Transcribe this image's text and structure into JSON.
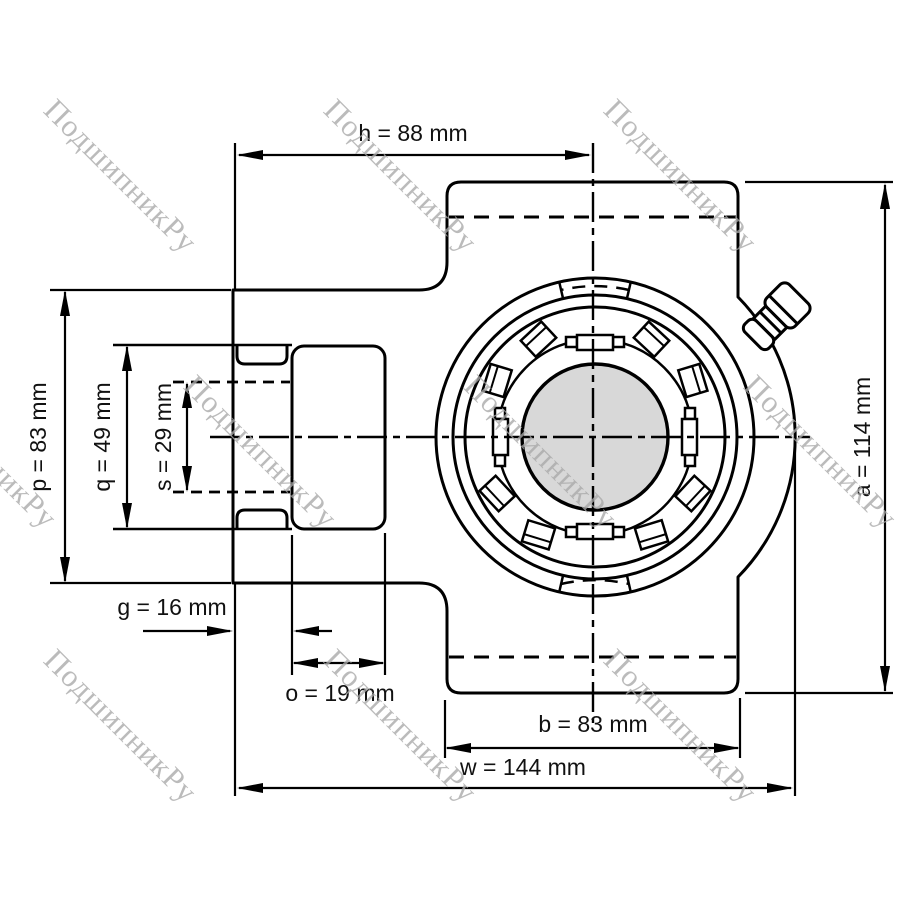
{
  "drawing": {
    "dims": {
      "h": {
        "name": "h",
        "value": 88,
        "unit": "mm",
        "label": "h = 88 mm"
      },
      "a": {
        "name": "a",
        "value": 114,
        "unit": "mm",
        "label": "a = 114 mm"
      },
      "p": {
        "name": "p",
        "value": 83,
        "unit": "mm",
        "label": "p = 83 mm"
      },
      "q": {
        "name": "q",
        "value": 49,
        "unit": "mm",
        "label": "q = 49 mm"
      },
      "s": {
        "name": "s",
        "value": 29,
        "unit": "mm",
        "label": "s = 29 mm"
      },
      "g": {
        "name": "g",
        "value": 16,
        "unit": "mm",
        "label": "g = 16 mm"
      },
      "o": {
        "name": "o",
        "value": 19,
        "unit": "mm",
        "label": "o = 19 mm"
      },
      "b": {
        "name": "b",
        "value": 83,
        "unit": "mm",
        "label": "b = 83 mm"
      },
      "w": {
        "name": "w",
        "value": 144,
        "unit": "mm",
        "label": "w = 144 mm"
      }
    }
  },
  "watermark": {
    "text": "ПодшипникРу"
  },
  "colors": {
    "line": "#000000",
    "shaft_fill": "#d8d8d8",
    "watermark": "#a8a8a8",
    "background": "#ffffff"
  }
}
